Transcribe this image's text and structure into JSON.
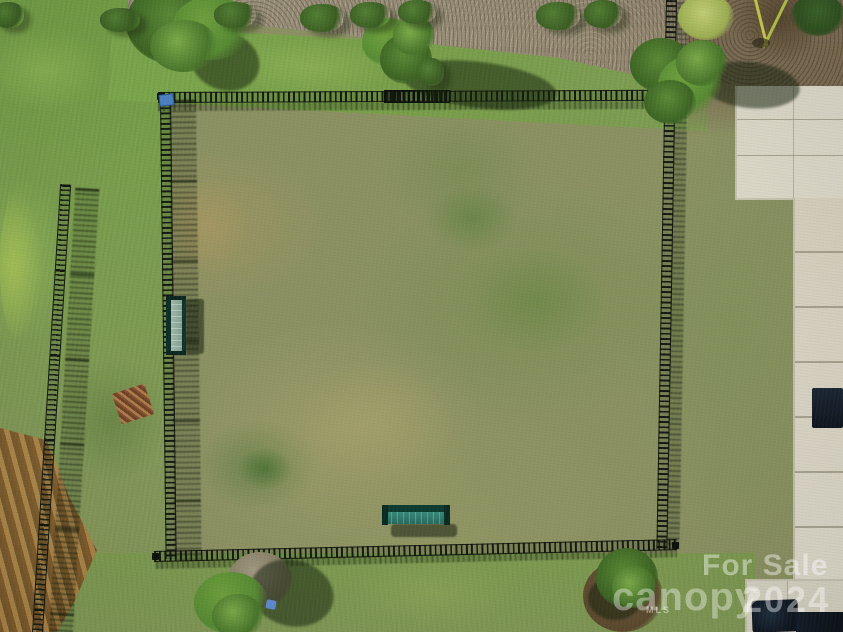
{
  "scene": {
    "description": "Aerial drone photo of a fenced grassy dog park with two teal benches, a gate, surrounding lawn, a mulch landscape bed with shrubs along the top, a second perimeter fence at left, and a concrete walkway along the right edge",
    "palette": {
      "field_grass": "#8b9162",
      "outer_grass": "#7aa04b",
      "mulch_bed": "#9d947f",
      "bare_dirt": "#7d6c53",
      "concrete": "#d9d5c6",
      "fence": "#11170f",
      "bench_teal": "#2f8274",
      "dead_brush": "#946f38"
    }
  },
  "watermark": {
    "for_sale": "For Sale",
    "brand": "canopy",
    "brand_sub": "MLS",
    "year": "2024"
  }
}
